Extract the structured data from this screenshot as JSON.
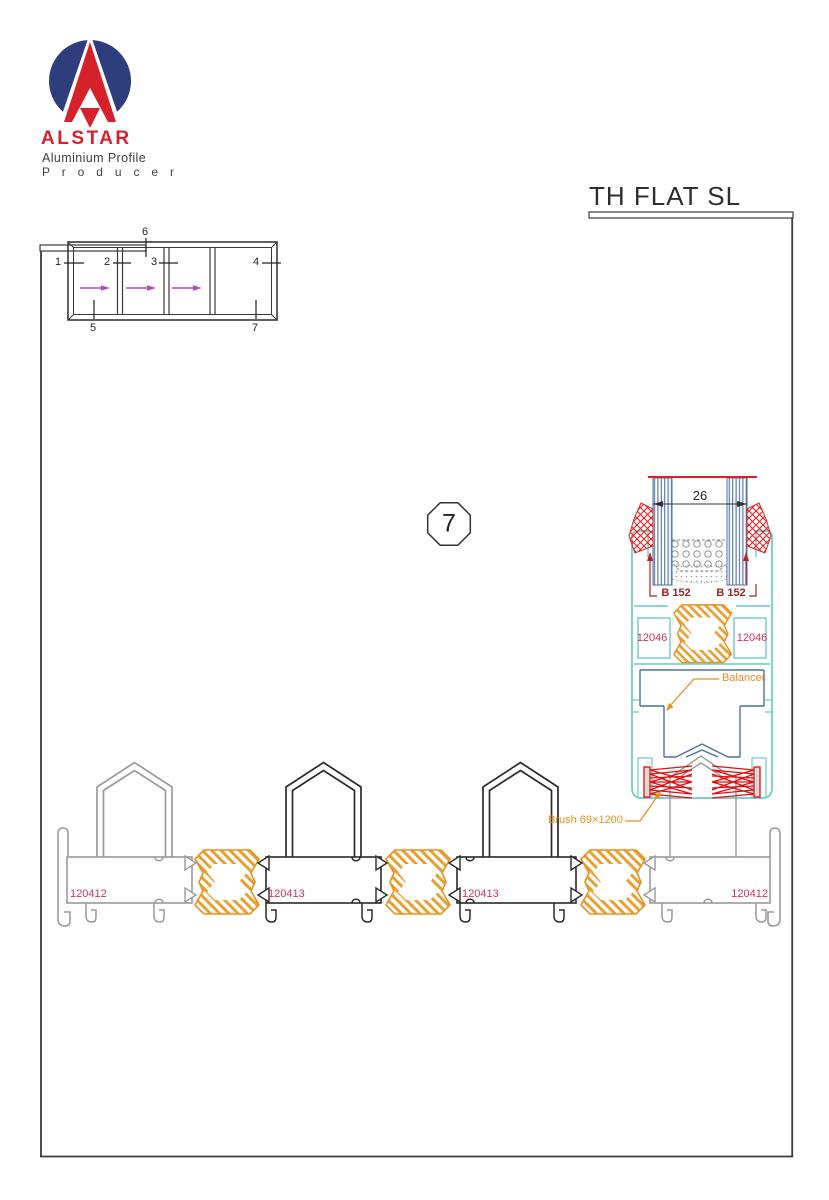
{
  "brand": {
    "name": "ALSTAR",
    "tagline": "Aluminium Profile",
    "tagline2": "P r o d u c e r"
  },
  "header": {
    "title": "TH FLAT SL"
  },
  "schematic": {
    "n1": "1",
    "n2": "2",
    "n3": "3",
    "n4": "4",
    "n5": "5",
    "n6": "6",
    "n7": "7"
  },
  "callout": {
    "number": "7"
  },
  "detail": {
    "dimension": "26",
    "gasket_left": "B 152",
    "gasket_right": "B 152",
    "clip_left": "12046",
    "clip_right": "12046",
    "balancer_label": "Balancer",
    "brush_label": "Brush 69×1200"
  },
  "section_labels": {
    "outer_left": "120412",
    "mid_left": "120413",
    "mid_right": "120413",
    "outer_right": "120412"
  },
  "colors": {
    "navy": "#2e3d7c",
    "logo_red": "#d6212a",
    "line_dark": "#3a3a3a",
    "cyan": "#66cccc",
    "steel_blue": "#4a6fa8",
    "orange": "#e8901d",
    "crimson": "#cc3355",
    "dark_red": "#992525",
    "brush_red": "#e01010",
    "magenta": "#bb44bb",
    "profile_gray": "#9a9a9a",
    "profile_black": "#2a2a2a"
  }
}
